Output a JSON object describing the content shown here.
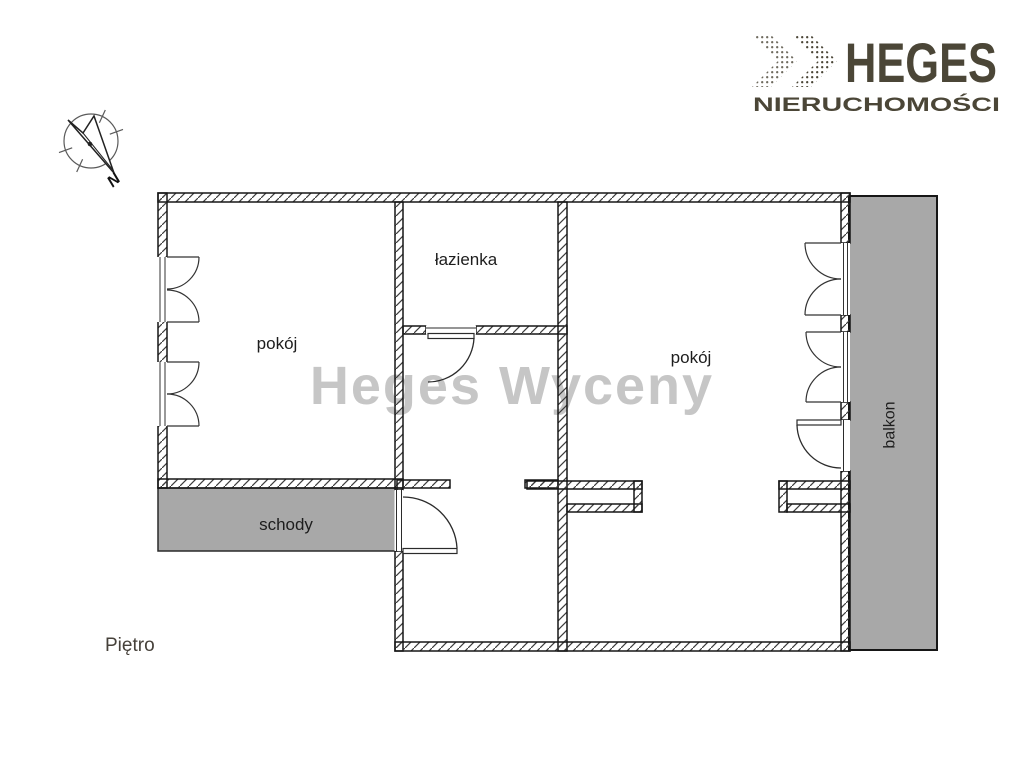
{
  "logo": {
    "brand": "HEGES",
    "tagline": "NIERUCHOMOŚCI",
    "color": "#4b4637"
  },
  "compass": {
    "north_label": "N"
  },
  "watermark": {
    "text": "Heges Wyceny",
    "color": "#c6c6c6"
  },
  "plan": {
    "room_left_label": "pokój",
    "bathroom_label": "łazienka",
    "room_right_label": "pokój",
    "stairs_label": "schody",
    "balcony_label": "balkon",
    "floor_label": "Piętro",
    "colors": {
      "area_fill": "#a8a8a8",
      "wall_line": "#161616",
      "label_color": "#1d1d1d"
    }
  }
}
